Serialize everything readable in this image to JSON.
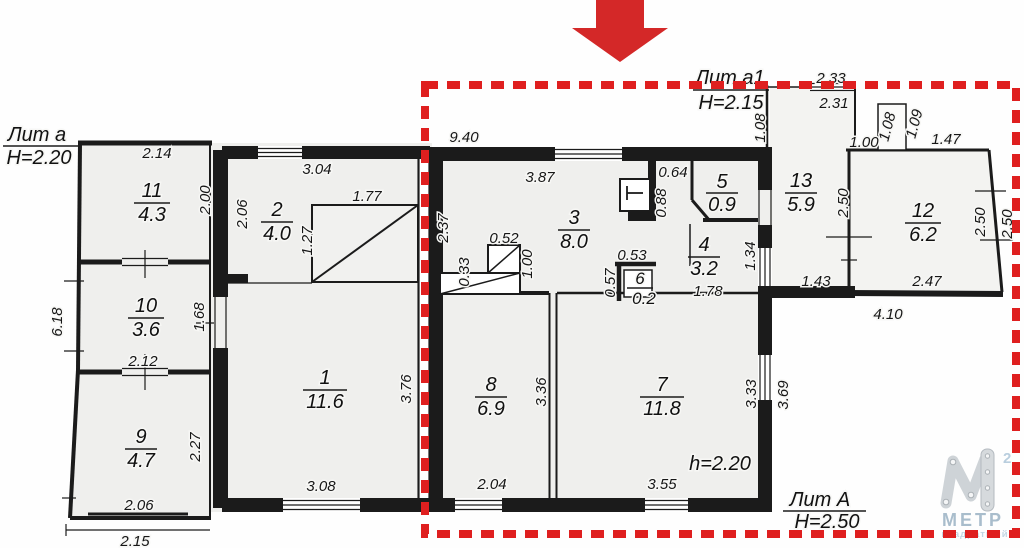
{
  "annotations": {
    "annex_left": {
      "label": "Лит а",
      "height": "Н=2.20"
    },
    "annex_top": {
      "label": "Лит а1",
      "height": "Н=2.15"
    },
    "main": {
      "label": "Лит А",
      "height": "Н=2.50"
    },
    "ceiling_note": "h=2.20"
  },
  "rooms": [
    {
      "number": "1",
      "area": "11.6"
    },
    {
      "number": "2",
      "area": "4.0"
    },
    {
      "number": "3",
      "area": "8.0"
    },
    {
      "number": "4",
      "area": "3.2"
    },
    {
      "number": "5",
      "area": "0.9"
    },
    {
      "number": "6",
      "area": "0.2"
    },
    {
      "number": "7",
      "area": "11.8"
    },
    {
      "number": "8",
      "area": "6.9"
    },
    {
      "number": "9",
      "area": "4.7"
    },
    {
      "number": "10",
      "area": "3.6"
    },
    {
      "number": "11",
      "area": "4.3"
    },
    {
      "number": "12",
      "area": "6.2"
    },
    {
      "number": "13",
      "area": "5.9"
    }
  ],
  "dimensions": {
    "annex": {
      "room11_width": "2.14",
      "room11_height": "2.00",
      "left_total": "6.18",
      "room10_height": "1.68",
      "room10_width": "2.12",
      "room9_height": "2.27",
      "room9_width": "2.06",
      "base_width": "2.15"
    },
    "mid": {
      "room2_width": "3.04",
      "room2_height": "2.06",
      "stair_width": "1.77",
      "stair_height": "1.27",
      "room1_width": "3.08",
      "room1_height": "3.76"
    },
    "main": {
      "top_total": "9.40",
      "room3_width": "3.87",
      "room3_height": "2.37",
      "stove_top": "0.52",
      "stove_left": "0.33",
      "stove_right": "1.00",
      "boiler_width": "0.64",
      "boiler_height": "0.88",
      "room6_width": "0.53",
      "room6_height": "0.57",
      "room4_width": "1.78",
      "room4_passage": "1.34",
      "room8_width": "2.04",
      "room8_height": "3.36",
      "room7_width": "3.55",
      "room7_height": "3.33",
      "right_wall": "3.69"
    },
    "right": {
      "top_outer": "2.33",
      "room13_top": "2.31",
      "room13_left": "1.08",
      "passage": "1.43",
      "room12_top_left": "1.00",
      "room12_top_right": "1.47",
      "porch_width": "1.08",
      "porch_height": "1.09",
      "room12_left": "2.50",
      "room12_right": "2.50",
      "room12_right_outer": "2.50",
      "room12_bottom": "2.47",
      "right_total": "4.10"
    }
  },
  "logo": {
    "letter": "М",
    "superscript": "2",
    "name": "МЕТР",
    "tagline": "квадратный"
  },
  "colors": {
    "highlight": "#df1f1f",
    "arrow": "#d42828",
    "walls": "#1b1b1b",
    "logo_gray": "#ced3d7",
    "logo_blue": "#a9bdcc"
  }
}
